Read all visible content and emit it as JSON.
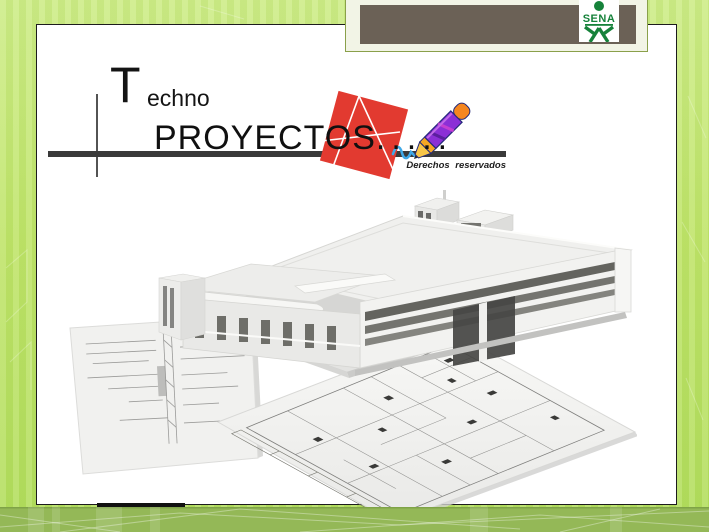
{
  "header": {
    "logo_text": "SENA"
  },
  "title": {
    "initial": "T",
    "rest": "echno",
    "line2": "PROYECTOS",
    "dots": ".....",
    "rights": "Derechos reservados"
  },
  "palette": {
    "frame_green": "#bfe468",
    "footer_band_green": "#94b857",
    "header_brown": "#6b6156",
    "sena_green": "#16823a",
    "stamp_red": "#e23a30",
    "pencil_purple": "#8b2fd6",
    "pencil_eraser_orange": "#f5861f",
    "pencil_collar_orange": "#f5a623",
    "scribble_blue": "#3fa9e8",
    "rule_dark": "#3a3a3a"
  },
  "icons": {
    "sena_logo": "sena-person-icon",
    "stamp": "drafting-stamp-icon",
    "pencil": "pencil-icon",
    "scribble": "scribble-icon",
    "artwork": "building-render-over-blueprints"
  }
}
